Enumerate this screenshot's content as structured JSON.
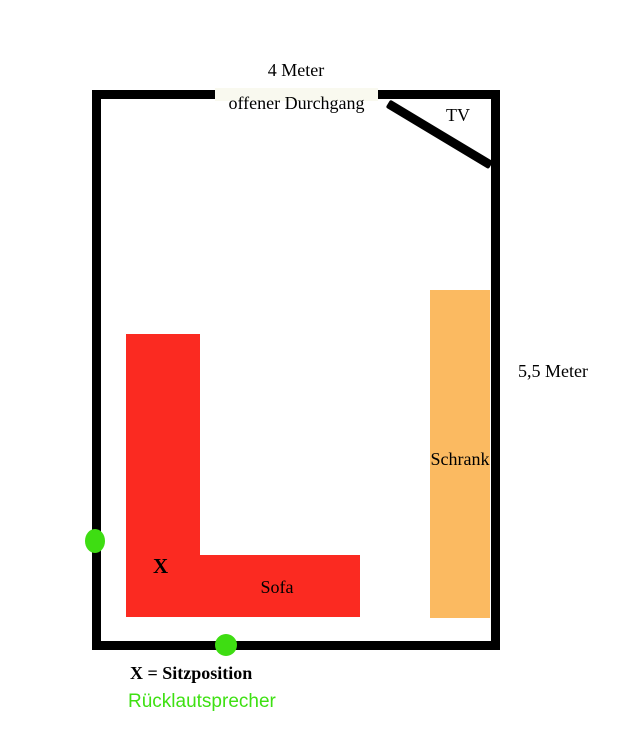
{
  "diagram": {
    "top_dimension": "4 Meter",
    "doorway_label": "offener Durchgang",
    "tv_label": "TV",
    "right_dimension": "5,5 Meter",
    "cabinet_label": "Schrank",
    "seat_marker": "X",
    "sofa_label": "Sofa"
  },
  "legend": {
    "seat_position": "X = Sitzposition",
    "rear_speaker": "Rücklautsprecher"
  },
  "colors": {
    "wall": "#000000",
    "sofa": "#fb2a21",
    "cabinet": "#fbba61",
    "speaker": "#3edd12",
    "speaker_text": "#3ee012",
    "doorway_fill": "#f9f9ef"
  }
}
